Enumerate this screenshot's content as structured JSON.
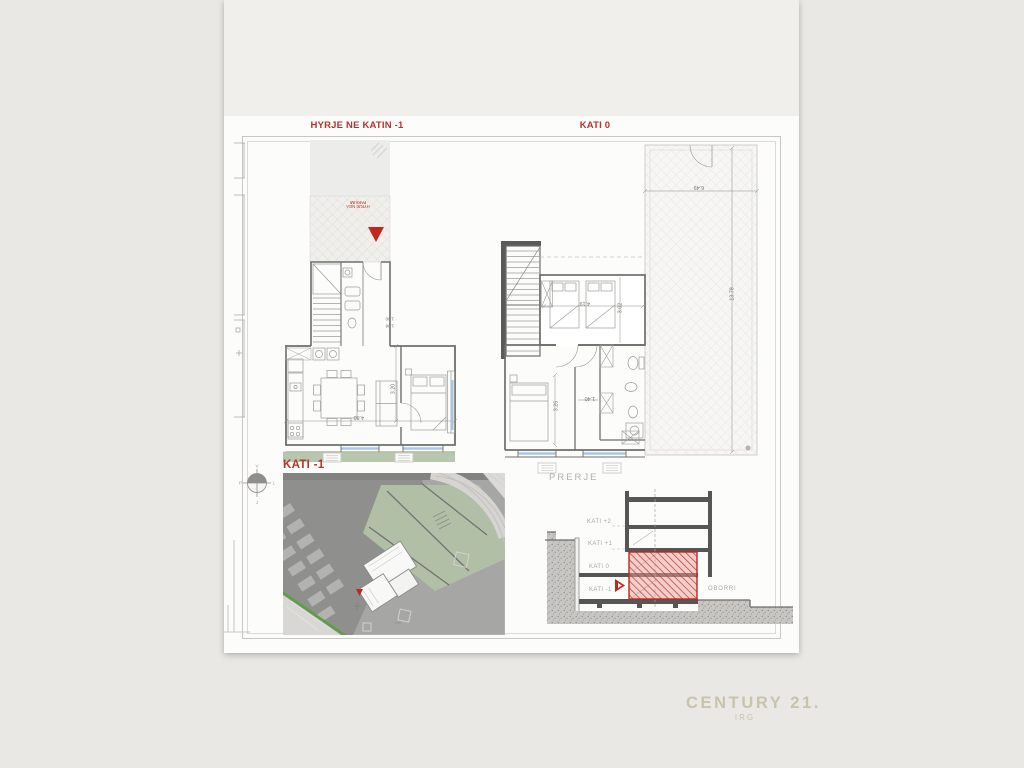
{
  "colors": {
    "accent_red": "#b4332c",
    "marker_red": "#c2271d",
    "glazing_blue": "#a9c9e6",
    "lawn_green": "#b8c6ad",
    "site_green": "#b0bfa6",
    "brand_beige": "#c8c3ac",
    "label_gray": "#b3b1ac"
  },
  "titles": {
    "entry": "HYRJE NE KATIN -1",
    "ground": "KATI 0",
    "basement": "KATI -1",
    "section": "PRERJE"
  },
  "plan_left": {
    "entry_marker": "HYRJE NGA PARKIMI",
    "dim_width": "4.80",
    "dim_depth": "3.20",
    "dim_stair_a": "1.90",
    "dim_stair_b": "1.98"
  },
  "plan_right": {
    "dim_bedroom_w": "4.19",
    "dim_bedroom_d": "3.02",
    "dim_bedroom2_d": "3.25",
    "dim_hall": "1.40",
    "terrace": {
      "dim_width": "6.49",
      "dim_length": "13.78"
    }
  },
  "site_plan": {
    "compass": {
      "north": "V",
      "east": "L",
      "south": "J",
      "west": "P"
    }
  },
  "section": {
    "levels": [
      "KATI +2",
      "KATI +1",
      "KATI 0",
      "KATI -1"
    ],
    "yard": "OBORRI"
  },
  "watermark": {
    "brand": "CENTURY 21.",
    "subtitle": "IRG"
  }
}
